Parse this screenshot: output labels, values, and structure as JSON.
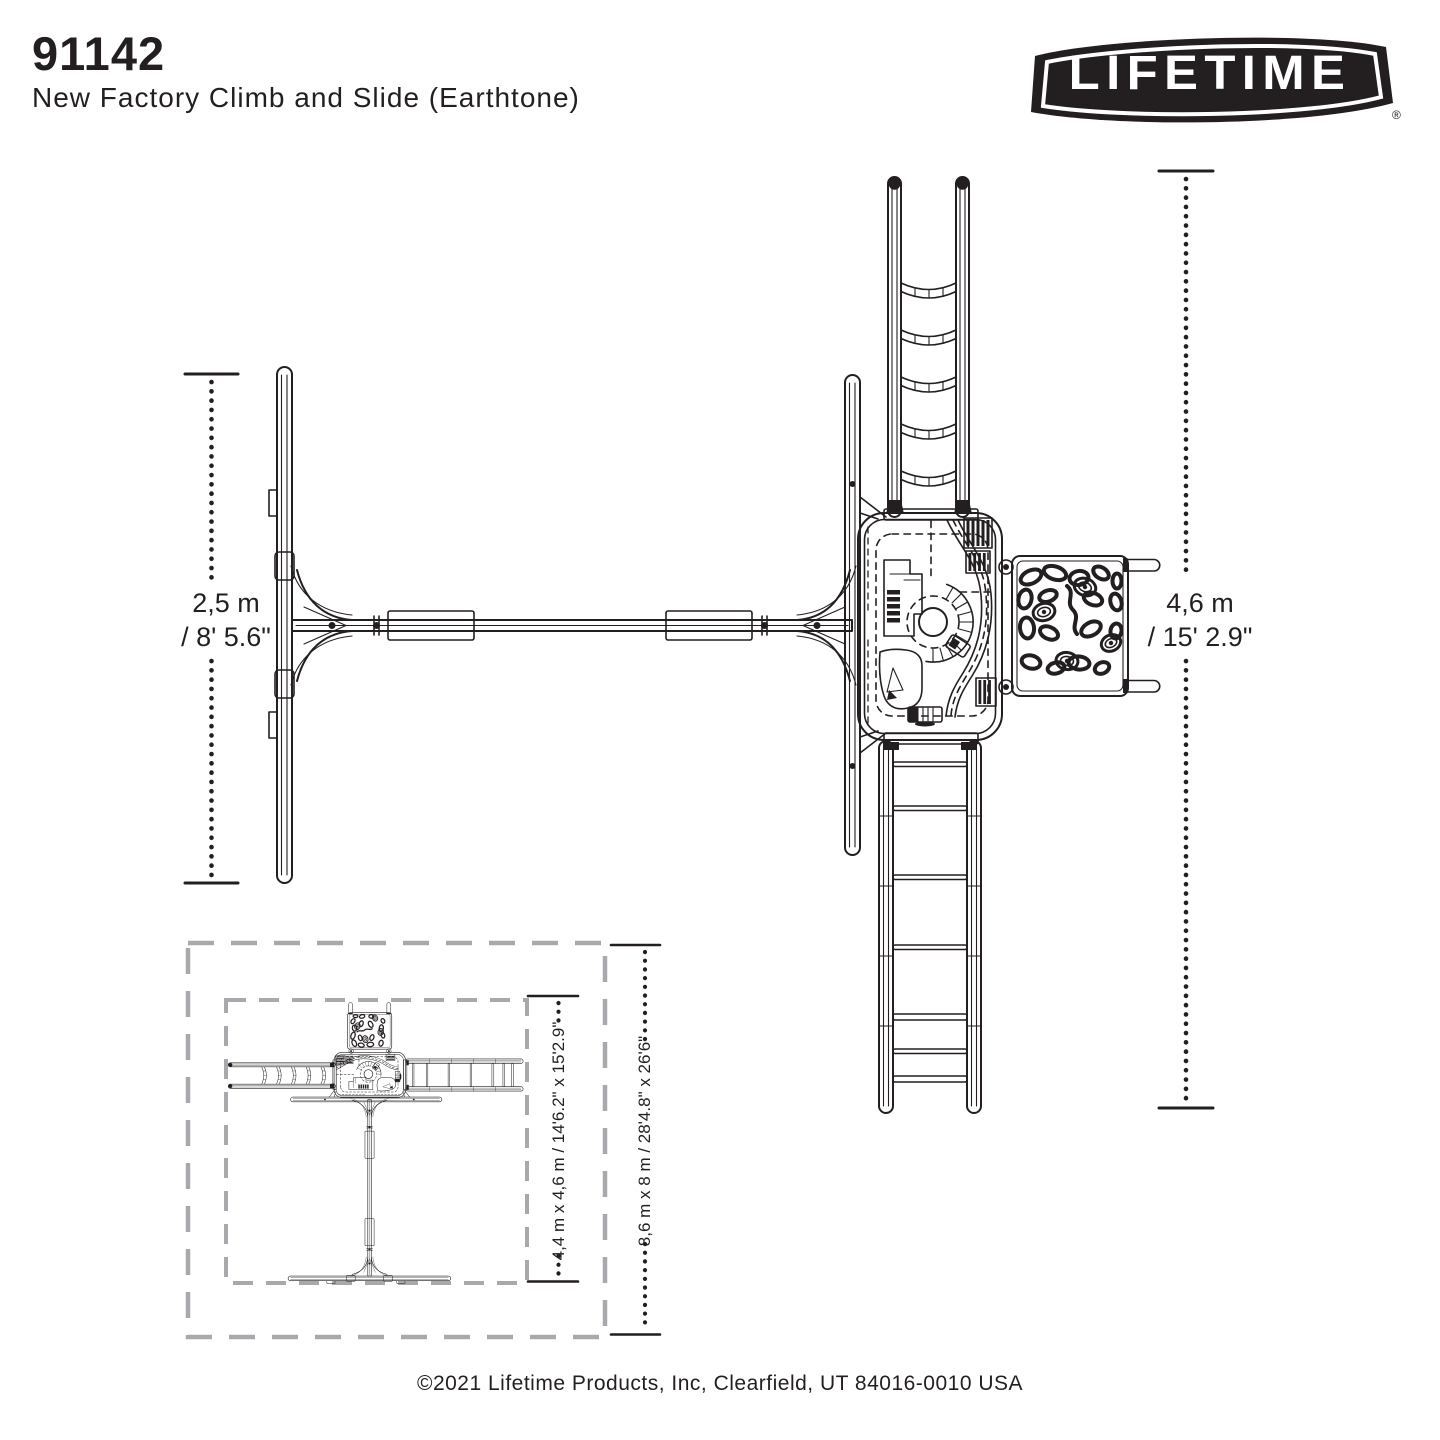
{
  "header": {
    "model_number": "91142",
    "product_name": "New Factory Climb and Slide (Earthtone)"
  },
  "brand": {
    "logo_text": "LIFETIME",
    "registered_mark": "®"
  },
  "dimensions": {
    "swing_width": {
      "metric": "2,5 m",
      "imperial": "/ 8' 5.6\""
    },
    "overall_depth": {
      "metric": "4,6 m",
      "imperial": "/ 15' 2.9\""
    },
    "unit_footprint": "4,4 m x 4,6 m / 14'6.2\" x 15'2.9\"",
    "safety_zone": "8,6 m x 8 m / 28'4.8\" x 26'6\""
  },
  "footer": {
    "copyright": "©2021 Lifetime Products, Inc, Clearfield, UT 84016-0010 USA"
  },
  "colors": {
    "line": "#231f20",
    "boundary_dash": "#a7a9ac",
    "background": "#ffffff"
  }
}
